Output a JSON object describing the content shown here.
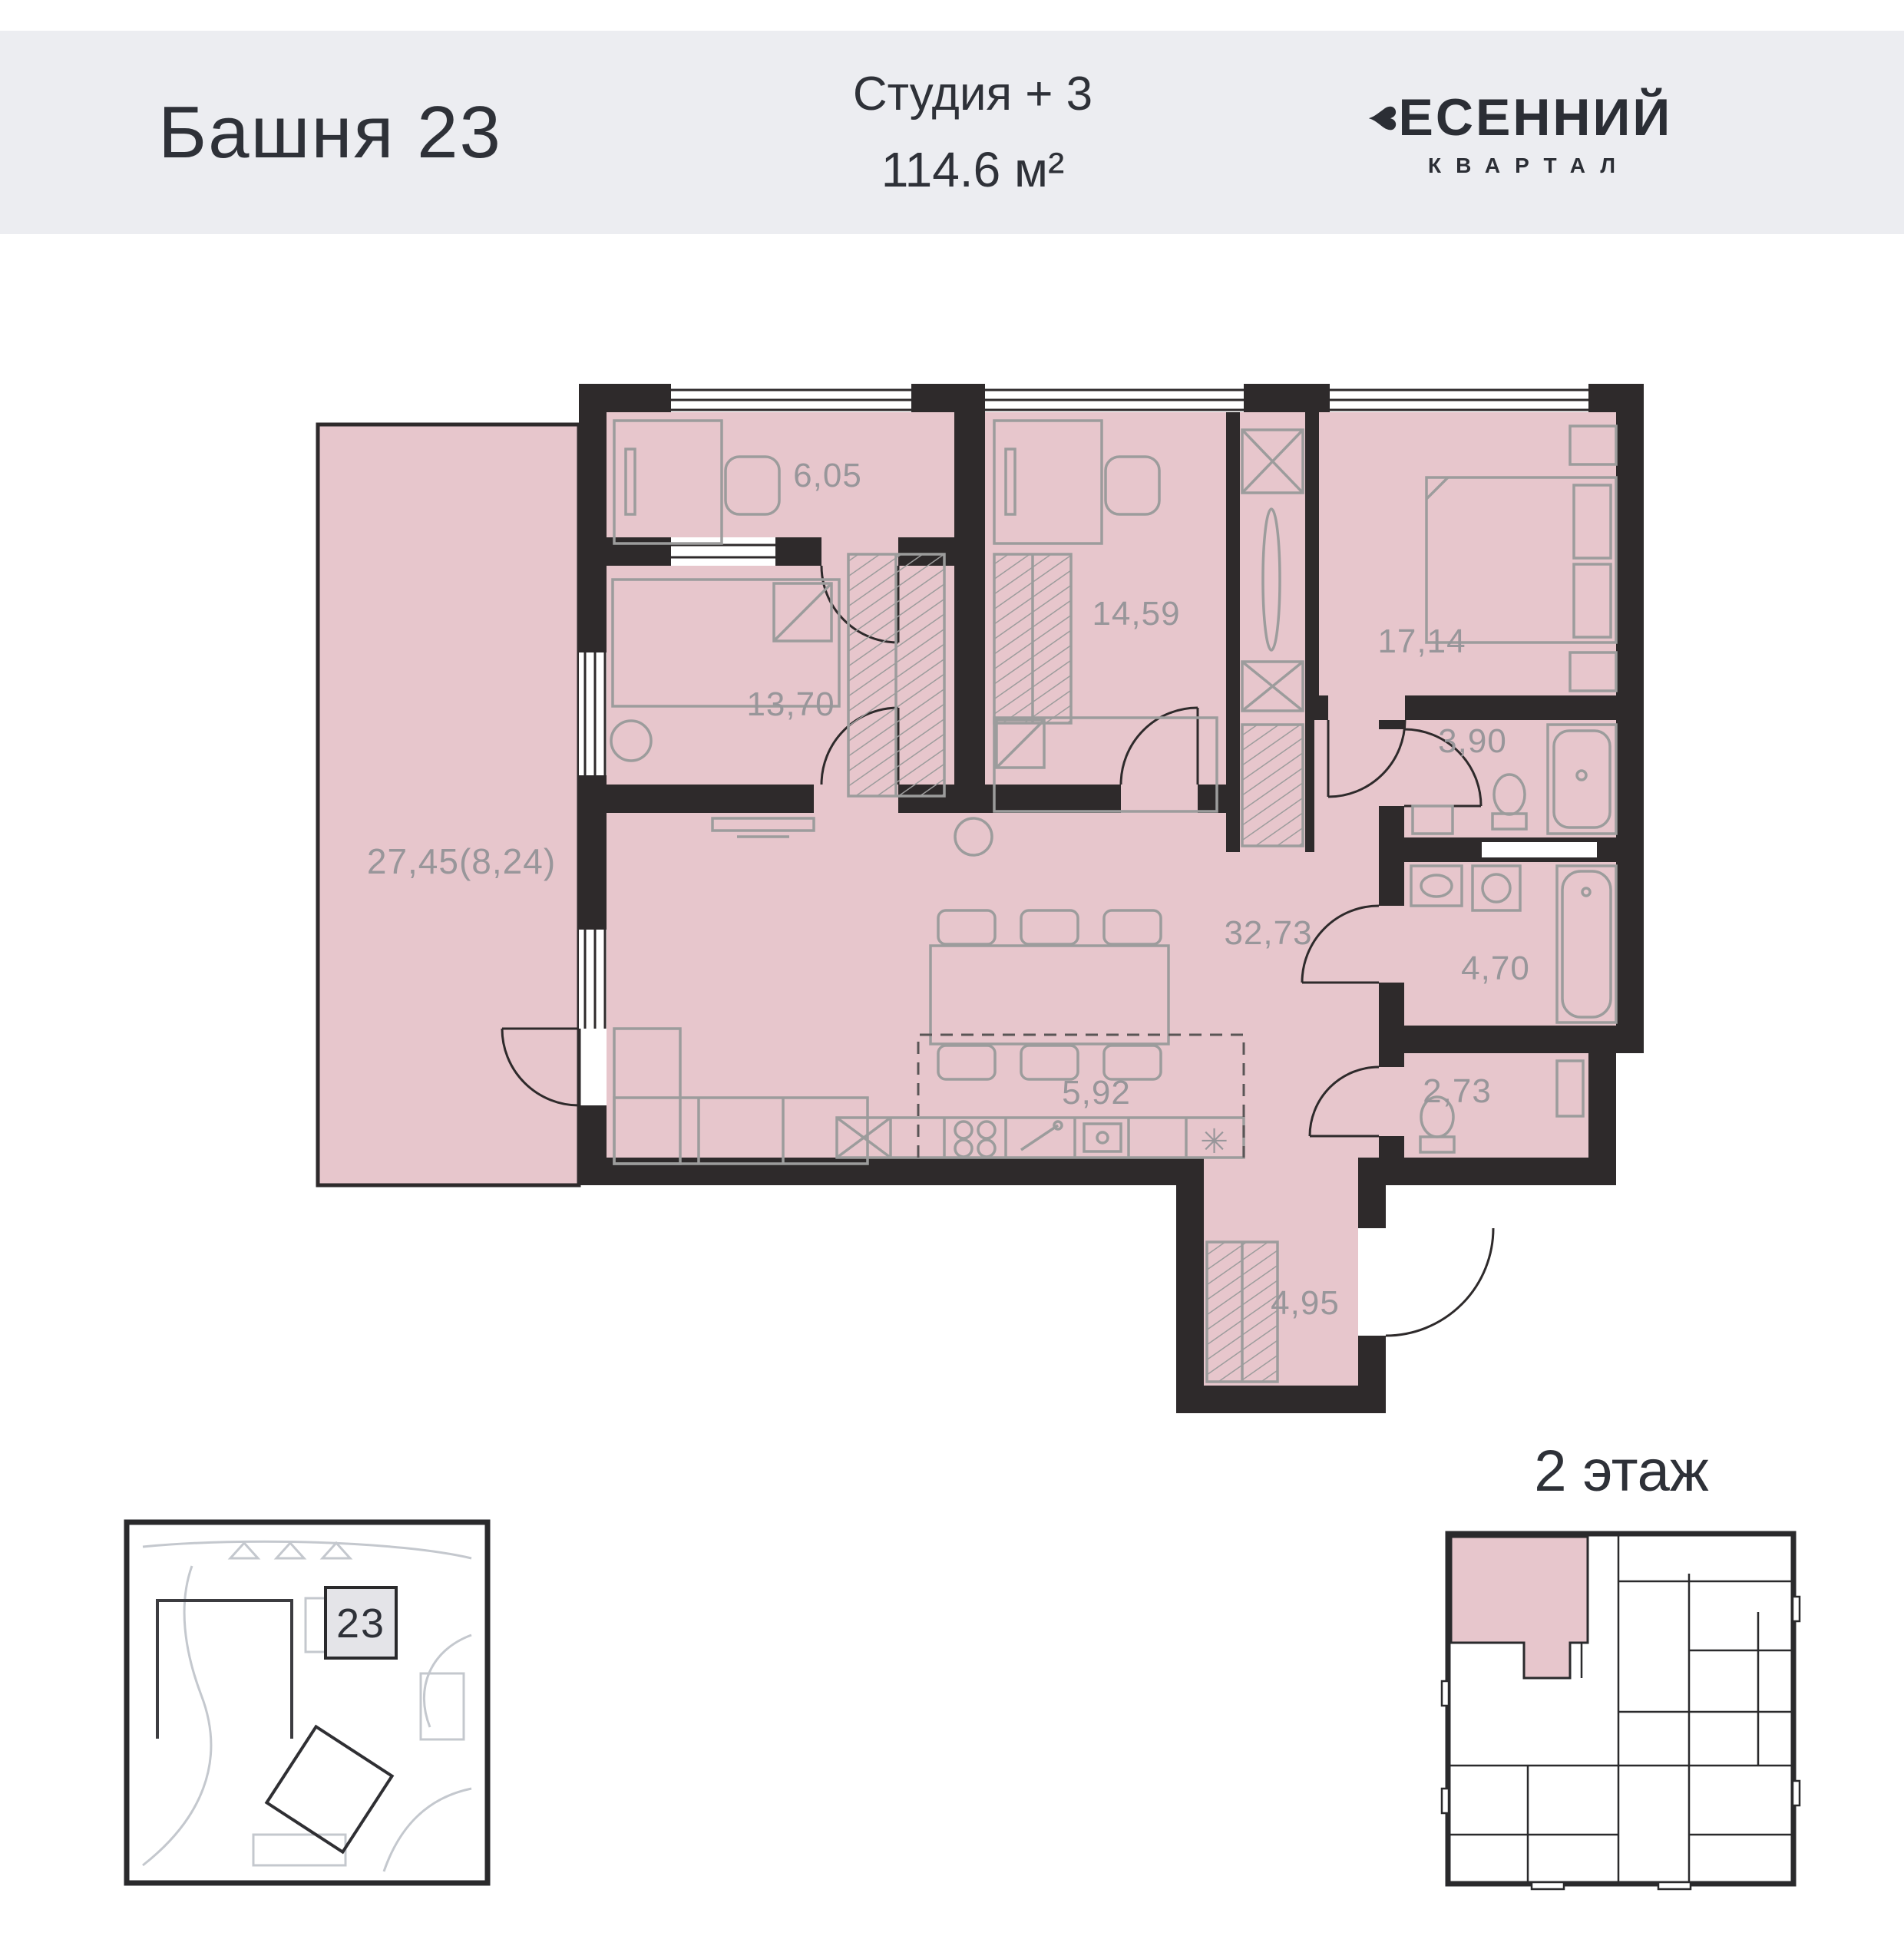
{
  "header": {
    "tower": "Башня 23",
    "unit_type": "Студия + 3",
    "unit_area": "114.6 м²",
    "brand": {
      "heart": "♥",
      "name": "ЕСЕННИЙ",
      "sub": "КВАРТАЛ"
    }
  },
  "plan": {
    "rooms": [
      {
        "name": "terrace",
        "area": "27,45(8,24)"
      },
      {
        "name": "wardrobe",
        "area": "6,05"
      },
      {
        "name": "bedroom-1",
        "area": "13,70"
      },
      {
        "name": "bedroom-2",
        "area": "14,59"
      },
      {
        "name": "bedroom-3",
        "area": "17,14"
      },
      {
        "name": "bathroom-1",
        "area": "3,90"
      },
      {
        "name": "living-kitchen",
        "area": "32,73"
      },
      {
        "name": "bathroom-2",
        "area": "4,70"
      },
      {
        "name": "kitchen-zone",
        "area": "5,92"
      },
      {
        "name": "wc",
        "area": "2,73"
      },
      {
        "name": "hall",
        "area": "4,95"
      }
    ],
    "kitchen_symbol": "✳"
  },
  "site_map": {
    "building_number": "23"
  },
  "floor_overview": {
    "title": "2 этаж"
  },
  "colors": {
    "accent_pink": "#e7c6cc",
    "wall_dark": "#2e2a2b",
    "header_bg": "#ecedf1",
    "furniture_gray": "#9c9c9c"
  }
}
